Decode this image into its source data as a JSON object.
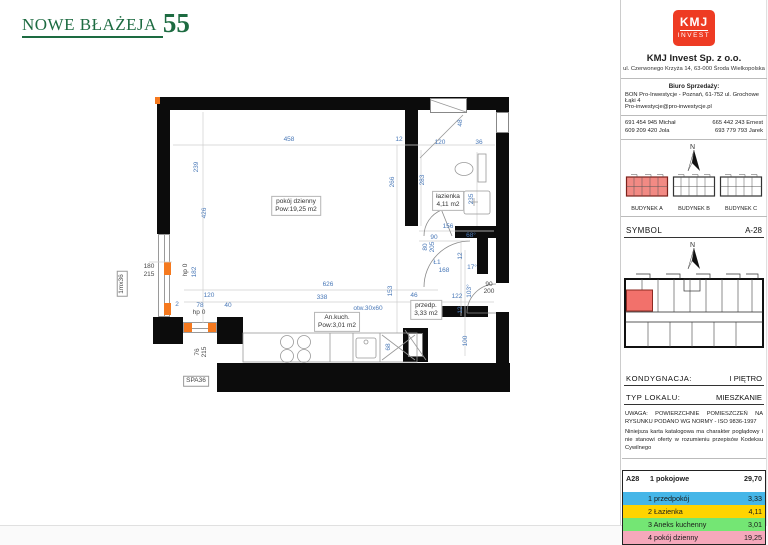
{
  "brand": {
    "title": "NOWE BŁAŻEJA",
    "number": "55"
  },
  "company": {
    "logo_top": "KMJ",
    "logo_bottom": "INVEST",
    "name": "KMJ Invest Sp. z o.o.",
    "address": "ul. Czerwonego Krzyża 14, 63-000 Środa Wielkopolska",
    "sales_heading": "Biuro Sprzedaży:",
    "sales_line1": "BON Pro-Inwestycje - Poznań, 61-752 ul. Grochowe Łąki 4",
    "sales_line2": "Pro-inwestycje@pro-inwestycje.pl",
    "phones": [
      {
        "number": "691 454 945",
        "name": "Michał"
      },
      {
        "number": "665 442 243",
        "name": "Ernest"
      },
      {
        "number": "609 209 420",
        "name": "Jola"
      },
      {
        "number": "693 779 793",
        "name": "Jarek"
      }
    ],
    "brand_color": "#ee3b23"
  },
  "buildings": [
    {
      "label": "BUDYNEK A",
      "highlighted": true
    },
    {
      "label": "BUDYNEK B",
      "highlighted": false
    },
    {
      "label": "BUDYNEK C",
      "highlighted": false
    }
  ],
  "meta": {
    "symbol_label": "SYMBOL",
    "symbol_value": "A-28",
    "floor_label": "KONDYGNACJA:",
    "floor_value": "I PIĘTRO",
    "type_label": "TYP LOKALU:",
    "type_value": "MIESZKANIE",
    "note_line1": "UWAGA: POWIERZCHNIE POMIESZCZEŃ NA RYSUNKU PODANO WG NORMY - ISO 9836-1997",
    "note_line2": "Niniejsza karta katalogowa ma charakter poglądowy i nie stanowi oferty w rozumieniu przepisów Kodeksu Cywilnego",
    "highlight_color": "#f2716b"
  },
  "area_table": {
    "unit": "A28",
    "type": "1 pokojowe",
    "total": "29,70",
    "rows": [
      {
        "num": "1",
        "name": "przedpokój",
        "area": "3,33",
        "color": "#45b6e8"
      },
      {
        "num": "2",
        "name": "Łazienka",
        "area": "4,11",
        "color": "#ffd400"
      },
      {
        "num": "3",
        "name": "Aneks kuchenny",
        "area": "3,01",
        "color": "#74e674"
      },
      {
        "num": "4",
        "name": "pokój dzienny",
        "area": "19,25",
        "color": "#f5a8bb"
      }
    ]
  },
  "plan": {
    "dim_color": "#4a79b8",
    "marker_color": "#f5791e",
    "room_labels": [
      {
        "name": "pokój dzienny",
        "area": "Pow:19,25 m2",
        "x": 296,
        "y": 206
      },
      {
        "name": "łazienka",
        "area": "4,11 m2",
        "x": 448,
        "y": 201
      },
      {
        "name": "An.kuch.",
        "area": "Pow:3,01 m2",
        "x": 337,
        "y": 322
      },
      {
        "name": "przedp.",
        "area": "3,33 m2",
        "x": 426,
        "y": 310
      }
    ],
    "dimensions": [
      {
        "t": "458",
        "x": 289,
        "y": 140
      },
      {
        "t": "12",
        "x": 399,
        "y": 140
      },
      {
        "t": "120",
        "x": 440,
        "y": 143
      },
      {
        "t": "36",
        "x": 479,
        "y": 143
      },
      {
        "t": "48",
        "x": 461,
        "y": 123,
        "v": 1
      },
      {
        "t": "239",
        "x": 197,
        "y": 167,
        "v": 1
      },
      {
        "t": "426",
        "x": 205,
        "y": 213,
        "v": 1
      },
      {
        "t": "266",
        "x": 393,
        "y": 182,
        "v": 1
      },
      {
        "t": "283",
        "x": 423,
        "y": 180,
        "v": 1
      },
      {
        "t": "235",
        "x": 472,
        "y": 199,
        "v": 1
      },
      {
        "t": "156",
        "x": 448,
        "y": 227
      },
      {
        "t": "90",
        "x": 434,
        "y": 238
      },
      {
        "t": "68°",
        "x": 471,
        "y": 236
      },
      {
        "t": "80",
        "x": 426,
        "y": 247,
        "v": 1
      },
      {
        "t": "205",
        "x": 433,
        "y": 247,
        "v": 1
      },
      {
        "t": "Ł1",
        "x": 437,
        "y": 263
      },
      {
        "t": "168",
        "x": 444,
        "y": 271
      },
      {
        "t": "12",
        "x": 461,
        "y": 256,
        "v": 1
      },
      {
        "t": "17°",
        "x": 472,
        "y": 268
      },
      {
        "t": "46",
        "x": 414,
        "y": 296
      },
      {
        "t": "122",
        "x": 457,
        "y": 297
      },
      {
        "t": "103°",
        "x": 470,
        "y": 291,
        "v": 1
      },
      {
        "t": "90",
        "x": 489,
        "y": 285,
        "c": "g"
      },
      {
        "t": "200",
        "x": 489,
        "y": 292,
        "c": "g"
      },
      {
        "t": "12",
        "x": 461,
        "y": 310,
        "v": 1
      },
      {
        "t": "100",
        "x": 466,
        "y": 341,
        "v": 1
      },
      {
        "t": "626",
        "x": 328,
        "y": 285
      },
      {
        "t": "338",
        "x": 322,
        "y": 298
      },
      {
        "t": "153",
        "x": 391,
        "y": 291,
        "v": 1
      },
      {
        "t": "otw.30x60",
        "x": 368,
        "y": 309
      },
      {
        "t": "68",
        "x": 389,
        "y": 347,
        "v": 1
      },
      {
        "t": "182",
        "x": 195,
        "y": 272,
        "v": 1
      },
      {
        "t": "hp 0",
        "x": 186,
        "y": 270,
        "v": 1,
        "c": "g"
      },
      {
        "t": "120",
        "x": 209,
        "y": 296
      },
      {
        "t": "78",
        "x": 200,
        "y": 306
      },
      {
        "t": "40",
        "x": 228,
        "y": 306
      },
      {
        "t": "2",
        "x": 177,
        "y": 305
      },
      {
        "t": "hp 0",
        "x": 199,
        "y": 313,
        "c": "g"
      },
      {
        "t": "180",
        "x": 149,
        "y": 267,
        "c": "g"
      },
      {
        "t": "215",
        "x": 149,
        "y": 275,
        "c": "g"
      },
      {
        "t": "76",
        "x": 198,
        "y": 352,
        "v": 1,
        "c": "g"
      },
      {
        "t": "215",
        "x": 205,
        "y": 352,
        "v": 1,
        "c": "g"
      },
      {
        "t": "SPA36",
        "x": 196,
        "y": 381,
        "c": "g",
        "box": 1
      },
      {
        "t": "1mx36",
        "x": 122,
        "y": 284,
        "v": 1,
        "c": "g",
        "box": 1
      }
    ]
  }
}
